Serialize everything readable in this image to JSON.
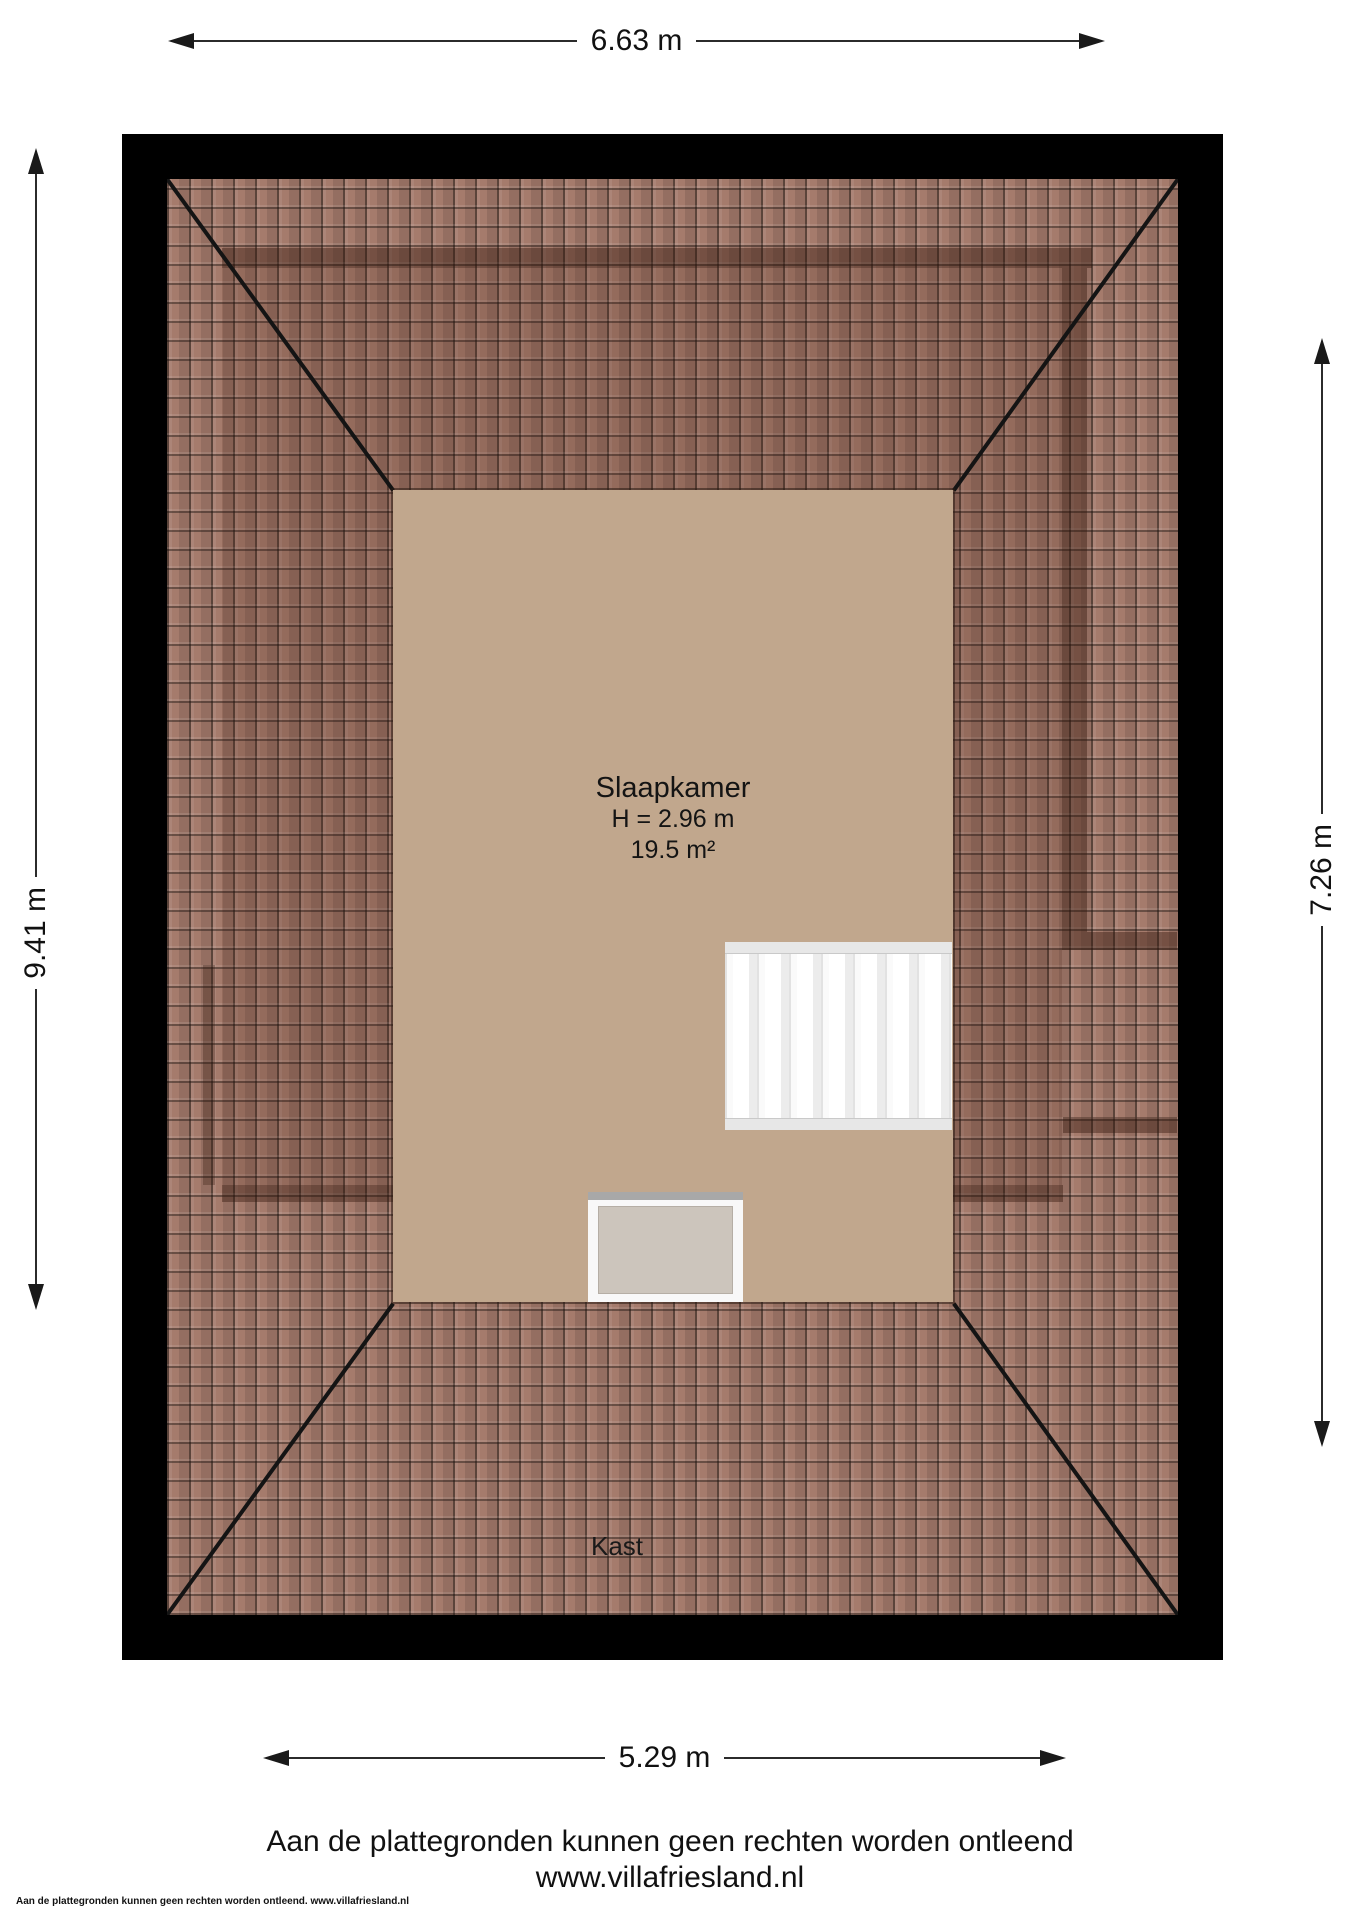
{
  "dimensions": {
    "top": "6.63 m",
    "left": "9.41 m",
    "right": "7.26 m",
    "bottom": "5.29 m"
  },
  "room": {
    "name": "Slaapkamer",
    "ceiling_height": "H = 2.96 m",
    "floor_area": "19.5 m²"
  },
  "closet_label": "Kast",
  "footer": {
    "disclaimer": "Aan de plattegronden kunnen geen rechten worden ontleend",
    "website": "www.villafriesland.nl",
    "fine_print": "Aan de plattegronden kunnen geen rechten worden ontleend. www.villafriesland.nl"
  },
  "colors": {
    "roof_tile": "#a57b6c",
    "floor": "#c1a78d",
    "frame": "#000000",
    "stairs": "#f7f7f7",
    "skylight_glass": "#ccc5bc",
    "dimension_line": "#2b2b2b"
  }
}
